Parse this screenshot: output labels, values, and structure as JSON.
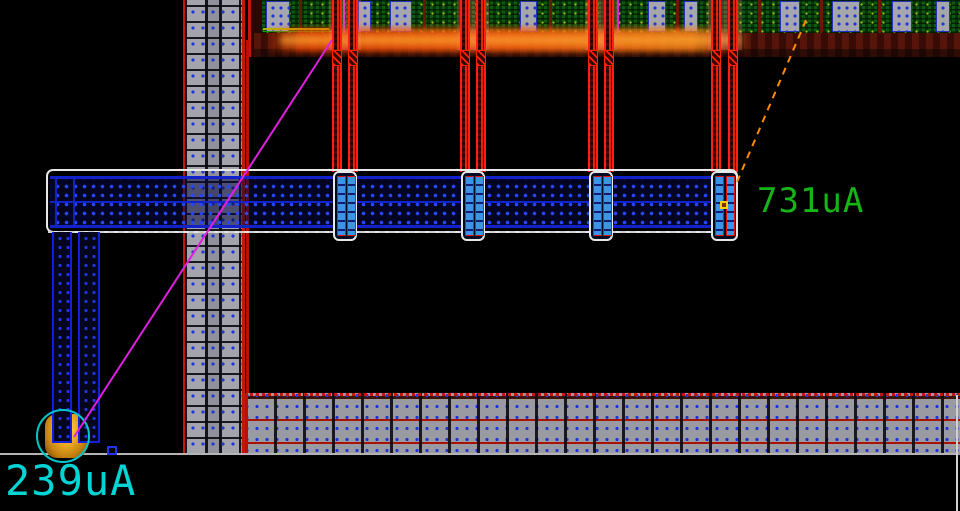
{
  "canvas": {
    "probes": [
      {
        "id": "probe-left",
        "value": "239uA",
        "color": "#00d4d4"
      },
      {
        "id": "probe-right",
        "value": "731uA",
        "color": "#16b516"
      }
    ],
    "flightlines": [
      {
        "id": "flightline-left",
        "color": "#e020e0",
        "style": "solid"
      },
      {
        "id": "flightline-right",
        "color": "#ff8c00",
        "style": "dashed"
      }
    ],
    "colors": {
      "background": "#000000",
      "selection_highlight": "#e8e8e8",
      "metal_blue": "#1122cc",
      "via_cyan": "#3d93e8",
      "bus_gray": "#a4a4ac",
      "net_red": "#ff2010",
      "cell_green": "#0e5a10",
      "power_ring_red": "#b51300",
      "probe_marker_orange": "#f0b020",
      "probe_ring_cyan": "#00c8c8",
      "current_glow": "#ff5a00"
    }
  }
}
